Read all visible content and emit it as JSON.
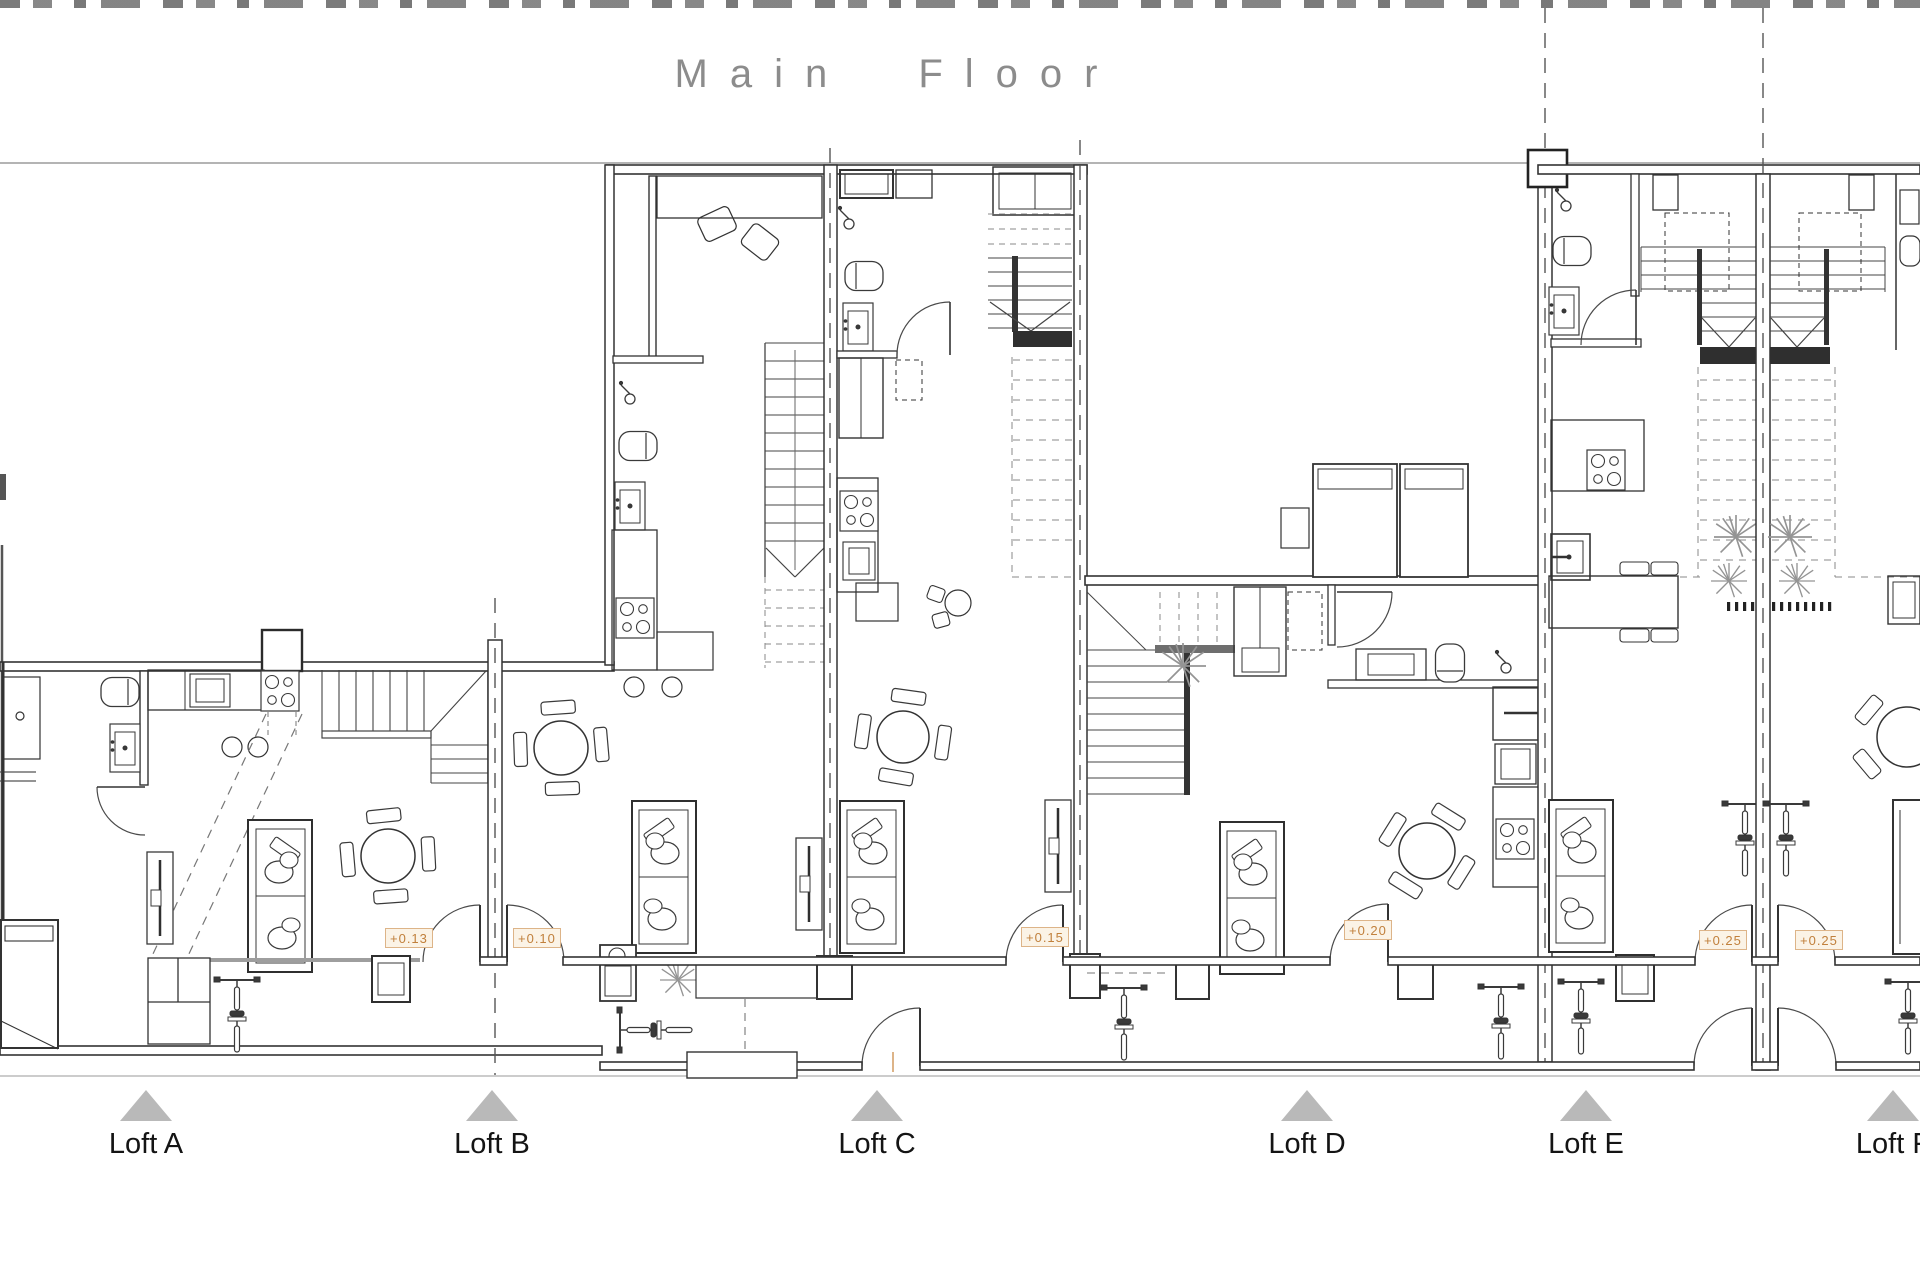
{
  "title": {
    "text": "Main Floor"
  },
  "lofts": [
    {
      "label": "Loft A",
      "elevation": "+0.13"
    },
    {
      "label": "Loft B",
      "elevation": "+0.10"
    },
    {
      "label": "Loft C",
      "elevation": "+0.15"
    },
    {
      "label": "Loft D",
      "elevation": "+0.20"
    },
    {
      "label": "Loft E",
      "elevation": "+0.25"
    },
    {
      "label": "Loft F",
      "elevation": "+0.25"
    }
  ],
  "colors": {
    "wall_line": "#333333",
    "muted_line": "#9b9b9b",
    "accent_text": "#c1803c",
    "accent_border": "#ddb488",
    "accent_bg": "#fbf3e6",
    "triangle": "#b9b9b9",
    "title_text": "#8c8c8c",
    "label_text": "#141414",
    "plant": "#949494"
  },
  "icons": {
    "entrance_marker": "triangle-up",
    "bicycle": "plan-symbol",
    "palm_plant": "plan-symbol",
    "stairs": "plan-symbol"
  }
}
